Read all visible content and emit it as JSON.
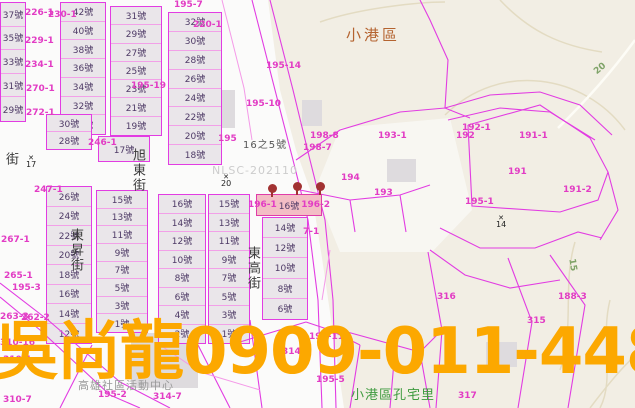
{
  "watermark_text": "吳尚龍0909-011-448",
  "district_label": "小港區",
  "village_label": "小港區孔宅里",
  "building_label": "高雄社區活動中心",
  "nlsc_watermark": "NLSC-202110",
  "lot_annotation": {
    "t": "16之5號",
    "x": 243,
    "y": 136
  },
  "colors": {
    "watermark": "#FCA800",
    "district": "#B4632F",
    "village": "#3F9B3F",
    "parcel_line": "#E23CE2",
    "lot_row_line": "#F2A0E8",
    "cadastral_label": "#E23CC4",
    "lot_label": "#4E3A66",
    "elevation_label": "#7FA368",
    "block_fill": "#EAE6EA",
    "terrain_fill": "#F2EEE4",
    "highlight_fill": "#F3BDC5",
    "pin": "#A23232"
  },
  "streets": [
    {
      "name": "旭東街",
      "x": 128,
      "y": 148
    },
    {
      "name": "東昇街",
      "x": 66,
      "y": 228
    },
    {
      "name": "東高街",
      "x": 243,
      "y": 246
    },
    {
      "name": "街",
      "x": 1,
      "y": 152
    }
  ],
  "blocks": [
    {
      "x": 0,
      "y": 2,
      "w": 26,
      "h": 120,
      "lots": [
        "37號",
        "35號",
        "33號",
        "31號",
        "29號"
      ]
    },
    {
      "x": 60,
      "y": 2,
      "w": 46,
      "h": 133,
      "lots": [
        "42號",
        "40號",
        "38號",
        "36號",
        "34號",
        "32號",
        "30號"
      ]
    },
    {
      "x": 110,
      "y": 6,
      "w": 52,
      "h": 130,
      "lots": [
        "31號",
        "29號",
        "27號",
        "25號",
        "23號",
        "21號",
        "19號"
      ]
    },
    {
      "x": 168,
      "y": 12,
      "w": 54,
      "h": 153,
      "lots": [
        "32號",
        "30號",
        "28號",
        "26號",
        "24號",
        "22號",
        "20號",
        "18號"
      ]
    },
    {
      "x": 46,
      "y": 114,
      "w": 46,
      "h": 36,
      "lots": [
        "30號",
        "28號"
      ]
    },
    {
      "x": 98,
      "y": 136,
      "w": 52,
      "h": 26,
      "lots": [
        "17號"
      ]
    },
    {
      "x": 46,
      "y": 186,
      "w": 46,
      "h": 158,
      "lots": [
        "26號",
        "24號",
        "22號",
        "20號",
        "18號",
        "16號",
        "14號",
        "12號"
      ]
    },
    {
      "x": 96,
      "y": 190,
      "w": 52,
      "h": 143,
      "lots": [
        "15號",
        "13號",
        "11號",
        "9號",
        "7號",
        "5號",
        "3號",
        "1號"
      ]
    },
    {
      "x": 158,
      "y": 194,
      "w": 48,
      "h": 150,
      "lots": [
        "16號",
        "14號",
        "12號",
        "10號",
        "8號",
        "6號",
        "4號",
        "2號"
      ]
    },
    {
      "x": 208,
      "y": 194,
      "w": 42,
      "h": 150,
      "lots": [
        "15號",
        "13號",
        "11號",
        "9號",
        "7號",
        "5號",
        "3號",
        "1號"
      ]
    },
    {
      "x": 262,
      "y": 217,
      "w": 46,
      "h": 103,
      "lots": [
        "14號",
        "12號",
        "10號",
        "8號",
        "6號"
      ]
    }
  ],
  "highlight_lot": {
    "x": 256,
    "y": 194,
    "w": 66,
    "h": 22,
    "label_left": "196-1",
    "lot": "16號",
    "label_right": "196-2"
  },
  "cadastral_labels": [
    {
      "t": "195-7",
      "x": 174,
      "y": 1
    },
    {
      "t": "226-1",
      "x": 25,
      "y": 9
    },
    {
      "t": "230-1",
      "x": 48,
      "y": 11
    },
    {
      "t": "229-1",
      "x": 25,
      "y": 37
    },
    {
      "t": "234-1",
      "x": 25,
      "y": 61
    },
    {
      "t": "270-1",
      "x": 26,
      "y": 85
    },
    {
      "t": "272-1",
      "x": 26,
      "y": 109
    },
    {
      "t": "220-1",
      "x": 193,
      "y": 21
    },
    {
      "t": "195-19",
      "x": 131,
      "y": 82
    },
    {
      "t": "195-14",
      "x": 266,
      "y": 62
    },
    {
      "t": "195-10",
      "x": 246,
      "y": 100
    },
    {
      "t": "195",
      "x": 218,
      "y": 135
    },
    {
      "t": "198-8",
      "x": 310,
      "y": 132
    },
    {
      "t": "198-7",
      "x": 303,
      "y": 144
    },
    {
      "t": "193-1",
      "x": 378,
      "y": 132
    },
    {
      "t": "194",
      "x": 341,
      "y": 174
    },
    {
      "t": "193",
      "x": 374,
      "y": 189
    },
    {
      "t": "192-1",
      "x": 462,
      "y": 124
    },
    {
      "t": "192",
      "x": 456,
      "y": 132
    },
    {
      "t": "191-1",
      "x": 519,
      "y": 132
    },
    {
      "t": "191",
      "x": 508,
      "y": 168
    },
    {
      "t": "191-2",
      "x": 563,
      "y": 186
    },
    {
      "t": "195-1",
      "x": 465,
      "y": 198
    },
    {
      "t": "246-1",
      "x": 88,
      "y": 139
    },
    {
      "t": "247-1",
      "x": 34,
      "y": 186
    },
    {
      "t": "267-1",
      "x": 1,
      "y": 236
    },
    {
      "t": "265-1",
      "x": 4,
      "y": 272
    },
    {
      "t": "195-3",
      "x": 12,
      "y": 284
    },
    {
      "t": "263-3",
      "x": 0,
      "y": 313
    },
    {
      "t": "262-2",
      "x": 21,
      "y": 314
    },
    {
      "t": "310-16",
      "x": 0,
      "y": 339
    },
    {
      "t": "310-1",
      "x": 3,
      "y": 356
    },
    {
      "t": "310-7",
      "x": 3,
      "y": 396
    },
    {
      "t": "195-11",
      "x": 309,
      "y": 333
    },
    {
      "t": "195-5",
      "x": 316,
      "y": 376
    },
    {
      "t": "195-2",
      "x": 98,
      "y": 391
    },
    {
      "t": "314-7",
      "x": 153,
      "y": 393
    },
    {
      "t": "314-1",
      "x": 282,
      "y": 348
    },
    {
      "t": "316",
      "x": 437,
      "y": 293
    },
    {
      "t": "315",
      "x": 527,
      "y": 317
    },
    {
      "t": "317",
      "x": 458,
      "y": 392
    },
    {
      "t": "188-3",
      "x": 558,
      "y": 293
    },
    {
      "t": "7-1",
      "x": 303,
      "y": 228
    }
  ],
  "survey_markers": [
    {
      "n": "17",
      "x": 26,
      "y": 155
    },
    {
      "n": "20",
      "x": 221,
      "y": 174
    },
    {
      "n": "14",
      "x": 496,
      "y": 215
    }
  ],
  "elevation_labels": [
    {
      "t": "20",
      "x": 594,
      "y": 64,
      "r": -40
    },
    {
      "t": "15",
      "x": 566,
      "y": 260,
      "r": 80
    }
  ],
  "pins": [
    {
      "x": 268,
      "y": 184
    },
    {
      "x": 293,
      "y": 182
    },
    {
      "x": 316,
      "y": 182
    }
  ],
  "buildings": [
    {
      "x": 213,
      "y": 90,
      "w": 22,
      "h": 38
    },
    {
      "x": 302,
      "y": 100,
      "w": 20,
      "h": 26
    },
    {
      "x": 387,
      "y": 159,
      "w": 29,
      "h": 23
    },
    {
      "x": 131,
      "y": 333,
      "w": 67,
      "h": 55
    },
    {
      "x": 486,
      "y": 342,
      "w": 31,
      "h": 25
    }
  ]
}
